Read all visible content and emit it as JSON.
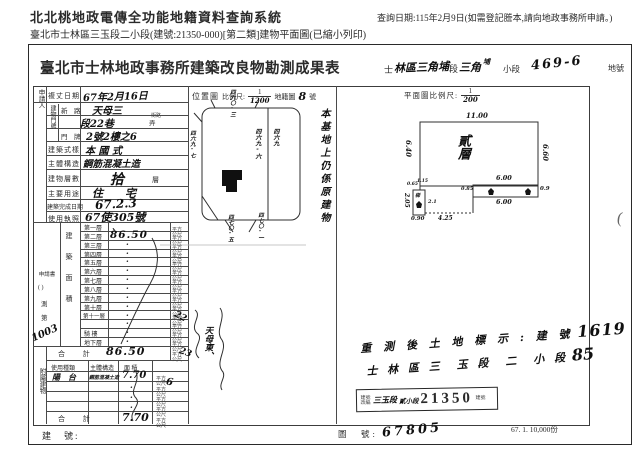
{
  "system_header": {
    "title": "北北桃地政電傳全功能地籍資料查詢系統",
    "query_date": "查詢日期:115年2月9日(如需登記謄本,請向地政事務所申請。)",
    "subtitle": "臺北市士林區三玉段二小段(建號:21350-000)[第二類]建物平面圖(已縮小列印)"
  },
  "doc": {
    "title": "臺北市士林地政事務所建築改良物勘測成果表",
    "fill": {
      "s1": "士",
      "hw1": "林區三角埔",
      "s2": "段",
      "hw2": "三角",
      "hw2_sup": "埔",
      "s3": "小段",
      "lot": "469-6",
      "s4": "地號"
    },
    "loc_header": {
      "panel": "位置圖",
      "scale_label": "比例尺:",
      "num": "1",
      "den": "1200",
      "map_label": "地籍圖",
      "map_no": "8",
      "suffix": "號"
    },
    "plan_header": {
      "label": "平面圖比例尺:",
      "num": "1",
      "den": "200"
    }
  },
  "table": {
    "applicant": "申請人",
    "appsheet": {
      "l1": "申請書",
      "l2": "(  )",
      "l3": "測",
      "l4": "第",
      "no": "1003"
    },
    "survey_date_label": "複丈日期",
    "survey_date_value": "67年2月16日",
    "door_label": "建物門牌",
    "addr": {
      "r1_label": "新　路",
      "r1_value": "天母三",
      "r1_unit": "街路",
      "r2_value": "段22巷",
      "r2_unit": "弄",
      "r3_label": "門　牌",
      "r3_value": "2號2樓之6"
    },
    "rows": [
      {
        "label": "建築式樣",
        "value": "本 國 式"
      },
      {
        "label": "主體構造",
        "value": "鋼筋混凝土造"
      },
      {
        "label": "建物層數",
        "value": "拾",
        "suffix": "層"
      },
      {
        "label": "主要用途",
        "value": "住　　宅"
      },
      {
        "label": "建築完成日期",
        "value": "67.2.3"
      },
      {
        "label": "使用執照",
        "value": "67使305號"
      }
    ],
    "area_section": "建築面積",
    "floor_rows": [
      {
        "label": "第一層",
        "value": "、"
      },
      {
        "label": "第二層",
        "value": "86.50"
      },
      {
        "label": "第三層",
        "value": "·"
      },
      {
        "label": "第四層",
        "value": "·"
      },
      {
        "label": "第五層",
        "value": "·"
      },
      {
        "label": "第六層",
        "value": "·"
      },
      {
        "label": "第七層",
        "value": "·"
      },
      {
        "label": "第八層",
        "value": "·"
      },
      {
        "label": "第九層",
        "value": "·"
      },
      {
        "label": "第十層",
        "value": "·"
      },
      {
        "label": "第十一層",
        "value": "·"
      },
      {
        "label": "",
        "value": "·"
      },
      {
        "label": "騎 樓",
        "value": "·"
      },
      {
        "label": "地下層",
        "value": "·"
      }
    ],
    "total_label": "合 計",
    "total_value": "86.50",
    "unit": "平方公尺",
    "annex": {
      "section": "附屬建物",
      "header": [
        "使用種類",
        "主體構造",
        "面 積"
      ],
      "kind": "陽　台",
      "structure": "鋼筋混凝土造",
      "area": "7.70",
      "empty_dot": "·",
      "total_label": "合 計",
      "total_value": "7.70"
    }
  },
  "location_map": {
    "lots": {
      "top": "四六〇-三",
      "left": "四六九-七",
      "center": "四六九-六",
      "right": "四六九",
      "bottom_left": "四七〇-五",
      "bottom_right": "四七〇-一"
    },
    "side_note": "本基地上仍係原建物"
  },
  "floor_plan": {
    "floor_label": "貳層",
    "stair": "梯",
    "dims": {
      "top": "11.00",
      "left": "6.40",
      "right": "6.60",
      "strip_top": "6.00",
      "strip_bottom": "6.00",
      "strip_right": "0.9",
      "strip_left": "0.85",
      "balcony_h": "2.05",
      "balcony_w": "0.90",
      "dotted": "4.25",
      "mid": "2.1",
      "t1": "0.65",
      "t2": "1.15"
    }
  },
  "notes": {
    "n1": "22",
    "n2": "23",
    "n3": "6",
    "street": "天母東、"
  },
  "resurvey": {
    "line1": "重 測 後 土 地 標 示 : 建 號",
    "no1": "1619",
    "line2": "士 林 區 三　玉 段　二　小 段",
    "no2": "85"
  },
  "stamp": {
    "prefix": "建號改編",
    "sec": "三玉段",
    "subsec": "貳小段",
    "number": "21350",
    "suffix": "建號"
  },
  "footer": {
    "building_no_label": "建　號:",
    "map_no_label": "圖　號:",
    "map_no_value": "67805",
    "print_info": "67. 1. 10,000份",
    "fold": "("
  },
  "colors": {
    "ink": "#222222",
    "paper": "#ffffff",
    "line": "#4a4a4a"
  }
}
